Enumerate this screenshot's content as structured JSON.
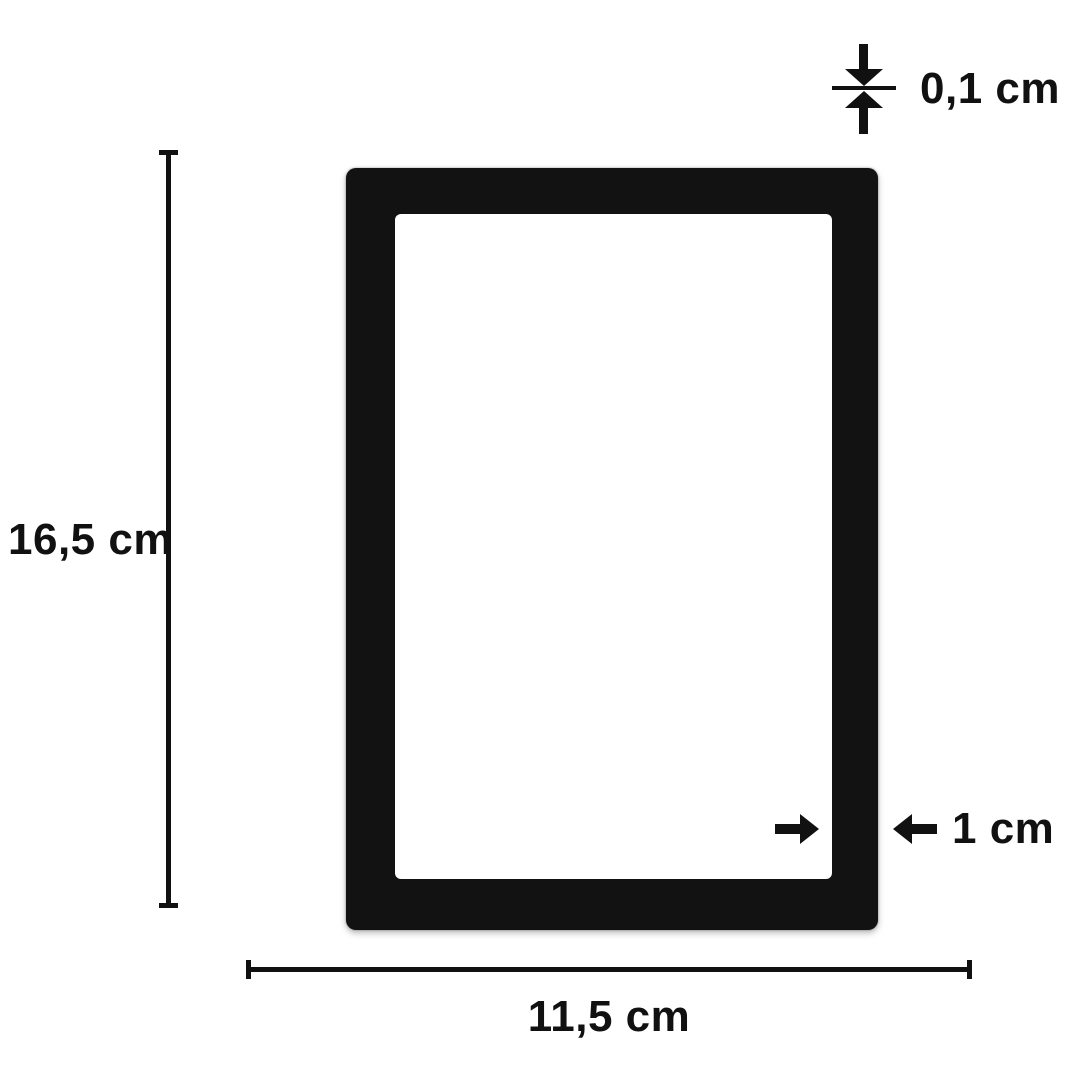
{
  "diagram": {
    "type": "product-dimension-diagram",
    "product": "black rectangular frame with rectangular cutout window"
  },
  "annotations": {
    "height": {
      "label": "16,5 cm"
    },
    "width": {
      "label": "11,5 cm"
    },
    "thickness": {
      "label": "0,1 cm"
    },
    "border_width": {
      "label": "1 cm"
    }
  },
  "colors": {
    "background": "#ffffff",
    "frame": "#121212",
    "line": "#111111",
    "text": "#111111"
  }
}
